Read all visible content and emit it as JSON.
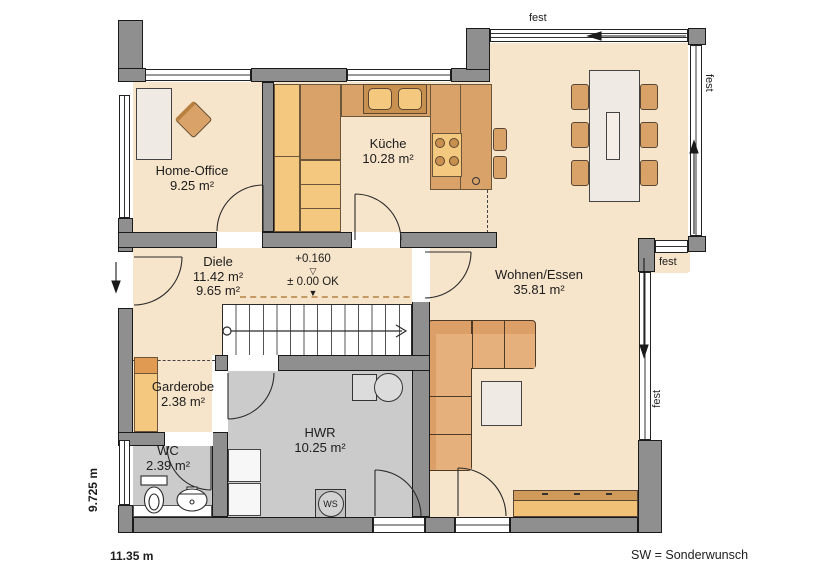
{
  "rooms": [
    {
      "name": "Home-Office",
      "area": "9.25 m²"
    },
    {
      "name": "Küche",
      "area": "10.28 m²"
    },
    {
      "name": "Diele",
      "area": "11.42 m²",
      "area_alt": "9.65 m²"
    },
    {
      "name": "Wohnen/Essen",
      "area": "35.81 m²"
    },
    {
      "name": "Garderobe",
      "area": "2.38 m²"
    },
    {
      "name": "WC",
      "area": "2.39 m²"
    },
    {
      "name": "HWR",
      "area": "10.25 m²"
    }
  ],
  "annotations": {
    "level_upper": "+0.160",
    "level_main": "± 0.00 OK",
    "tri_hollow": "▽",
    "tri_filled": "▼",
    "fest": "fest",
    "ws": "WS",
    "dim_width": "11.35 m",
    "dim_height": "9.725 m",
    "legend_sw": "SW = Sonderwunsch"
  },
  "colors": {
    "floor_living": "#f7e5cb",
    "floor_utility": "#cbcbcb",
    "wall": "#8f8f8f",
    "furniture_tan": "#d9a268",
    "furniture_light": "#f4c87e",
    "sofa": "#dc9f68",
    "table_white": "#efeae3",
    "dashed_headroom": "#c49a66"
  }
}
